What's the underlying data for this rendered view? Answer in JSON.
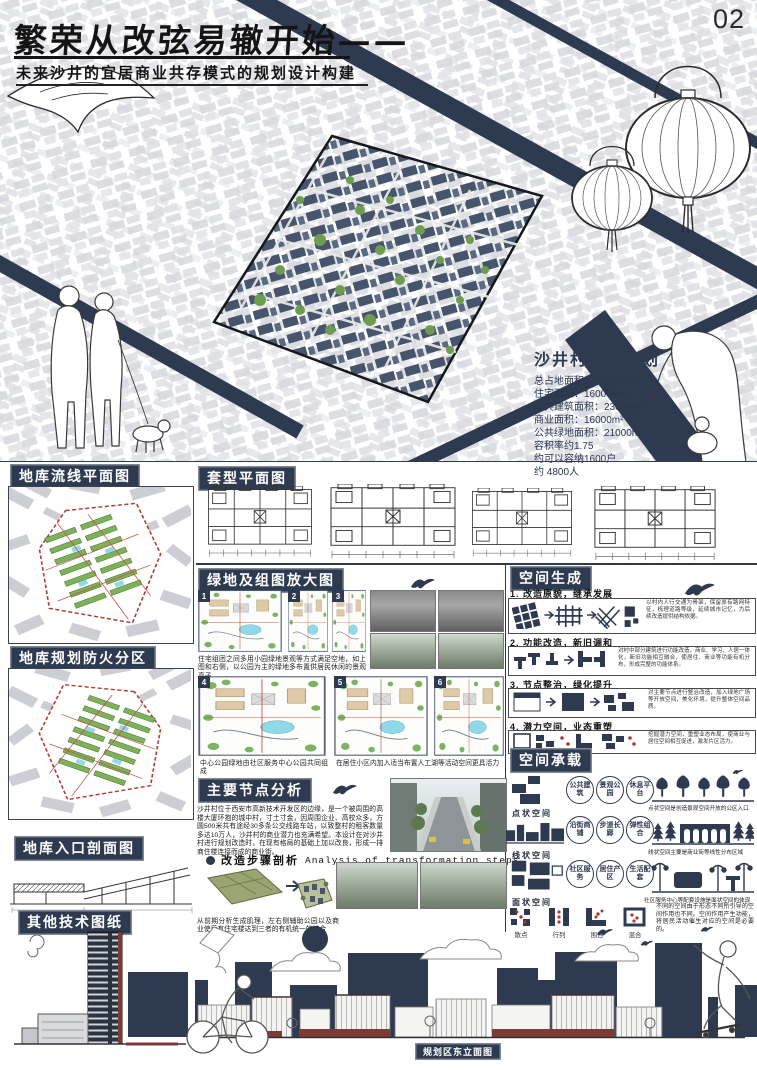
{
  "page_number": "02",
  "header": {
    "title": "繁荣从改弦易辙开始——",
    "subtitle": "未来沙井的宜居商业共存模式的规划设计构建"
  },
  "site_stats": {
    "heading": "沙井村区域规划",
    "lines": [
      "总占地面积：220000m²",
      "住宅面积：160000m²",
      "公共建筑面积：23000m²",
      "商业面积：16000m²",
      "公共绿地面积：21000m²",
      "容积率约1.75",
      "约可以容纳1600户",
      "约 4800人"
    ]
  },
  "left_column": {
    "garage_flow_label": "地库流线平面图",
    "garage_fire_label": "地库规划防火分区",
    "garage_section_label": "地库入口剖面图",
    "other_drawings_label": "其他技术图纸"
  },
  "unit_plans": {
    "title": "套型平面图"
  },
  "green_section": {
    "title": "绿地及组图放大图",
    "plan_numbers": [
      "1",
      "2",
      "3",
      "4",
      "5",
      "6"
    ],
    "caption_top": "住宅组团之间多用小园绿地景观等方式满足空地，如上图和右侧，以公园为主的绿地多布置供居民休闲的景观亭子",
    "caption_center": "中心公园绿地由社区服务中心公园共同组成",
    "caption_right": "在居住小区内加入适当布置人工湖等活动空间更具活力"
  },
  "space_generation": {
    "title": "空间生成",
    "steps": [
      {
        "label": "1. 改造原貌，继承发展",
        "desc": "以村内人行交通为骨架，保留原有路网特征，梳理道路等级，延续城市记忆，为后续改造提供结构依据。"
      },
      {
        "label": "2. 功能改造，新旧调和",
        "desc": "对村中部分建筑进行功能改造，商业、学习、人居一体化，新旧功能相互融合，使居住、商业等功能有机分布，形成完整的功能体系。"
      },
      {
        "label": "3. 节点整治，绿化提升",
        "desc": "对主要节点进行整治改造，加入绿地广场等开放空间，美化环境，提升整体空间品质。"
      },
      {
        "label": "4. 潜力空间，业态重塑",
        "desc": "挖掘潜力空间，重塑业态布局，使商业与居住空间相互促进，激发片区活力。"
      }
    ]
  },
  "node_analysis": {
    "title": "主要节点分析",
    "paragraph": "沙井村位于西安市高新技术开发区的边缘，是一个被周围的高楼大厦环抱的城中村，寸土寸金，因周围企业、高校众多，方圆500米共有途经30多条公交线路车站，以致整村的租客数量多达10万人，沙井村的商业潜力也充满希望。本设计在对沙井村进行规划改造时，在现有格局的基础上加以改良，形成一排商住楼连接而成的商业街。",
    "bullet_cn": "改造步骤剖析",
    "bullet_en": "Analysis of transformation steps",
    "caption": "从前期分析生成肌理，左右侧辅助公园以及商业使后有住宅楼达到三者的有机统一的结合"
  },
  "space_capacity": {
    "title": "空间承载",
    "rows": [
      {
        "label": "点状空间",
        "tags": [
          "公共建筑",
          "景观公园",
          "休息平台"
        ],
        "caption": "点状空间是创造景观空间开放的公区入口"
      },
      {
        "label": "线状空间",
        "tags": [
          "沿街商铺",
          "步道长廊",
          "弹性组合"
        ],
        "caption": "线状空间主要是商业街等线性分布区域"
      },
      {
        "label": "面状空间",
        "tags": [
          "社区服务",
          "居住产区",
          "生活配套"
        ],
        "caption": "社区服务中心等配套设施是面状空间的体现"
      }
    ],
    "icon_labels": [
      "散点",
      "行列",
      "围合",
      "混合"
    ],
    "paragraph": "不同的空间由于形态不同所引导的空间作用也不同。空间作用产生功能，将居民活动催生对应的空间是必要的。"
  },
  "bottom": {
    "elevation_label": "规划区东立面图"
  },
  "colors": {
    "navy": "#2e3a50",
    "red": "#8a3b32",
    "green": "#76a258",
    "cyan": "#8bd7e4"
  }
}
